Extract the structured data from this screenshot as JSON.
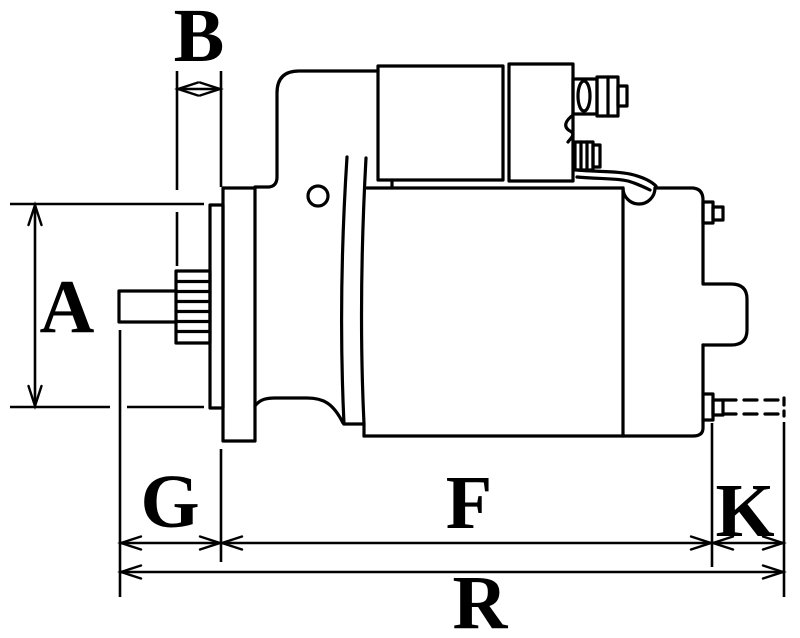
{
  "figure": {
    "kind": "technical dimension drawing",
    "subject": "starter motor side view",
    "background_color": "#ffffff",
    "line_color": "#000000"
  },
  "dimensions": {
    "B": {
      "label": "B",
      "axis": "horizontal"
    },
    "A": {
      "label": "A",
      "axis": "vertical"
    },
    "G": {
      "label": "G",
      "axis": "horizontal"
    },
    "F": {
      "label": "F",
      "axis": "horizontal"
    },
    "K": {
      "label": "K",
      "axis": "horizontal"
    },
    "R": {
      "label": "R",
      "axis": "horizontal"
    }
  }
}
